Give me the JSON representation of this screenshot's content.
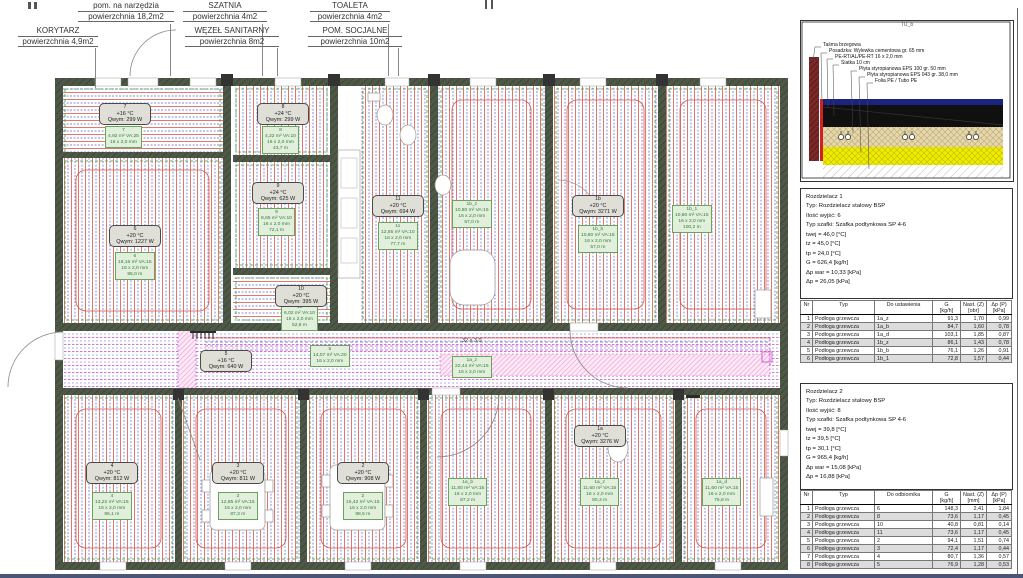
{
  "top_labels": [
    {
      "title": "KORYTARZ",
      "area": "powierzchnia 4,9m2"
    },
    {
      "title": "pom. na narzędzia",
      "area": "powierzchnia 18,2m2"
    },
    {
      "title": "SZATNIA",
      "area": "powierzchnia 4m2"
    },
    {
      "title": "WĘZEŁ SANITARNY",
      "area": "powierzchnia 8m2"
    },
    {
      "title": "TOALETA",
      "area": "powierzchnia 4m2"
    },
    {
      "title": "POM. SOCJALNE",
      "area": "powierzchnia 10m2"
    }
  ],
  "plan": {
    "boxes": {
      "b7": {
        "num": "7",
        "temp": "+16 °C",
        "q": "Qwym: 299 W"
      },
      "b8": {
        "num": "8",
        "temp": "+24 °C",
        "q": "Qwym: 299 W"
      },
      "b6": {
        "num": "6",
        "temp": "+20 °C",
        "q": "Qwym: 1227 W"
      },
      "b9": {
        "num": "9",
        "temp": "+24 °C",
        "q": "Qwym: 625 W"
      },
      "b11": {
        "num": "11",
        "temp": "+20 °C",
        "q": "Qwym: 694 W"
      },
      "b10": {
        "num": "10",
        "temp": "+20 °C",
        "q": "Qwym: 395 W"
      },
      "b5": {
        "num": "5",
        "temp": "+16 °C",
        "q": "Qwym: 640 W"
      },
      "b4": {
        "num": "4",
        "temp": "+20 °C",
        "q": "Qwym: 812 W"
      },
      "b3": {
        "num": "3",
        "temp": "+20 °C",
        "q": "Qwym: 811 W"
      },
      "b2": {
        "num": "2",
        "temp": "+20 °C",
        "q": "Qwym: 908 W"
      },
      "b1b": {
        "num": "1b",
        "temp": "+20 °C",
        "q": "Qwym: 3271 W"
      },
      "b1a": {
        "num": "1a",
        "temp": "+20 °C",
        "q": "Qwym: 3276 W"
      }
    },
    "green": {
      "g7": "7\n4,92 m² VA:25\n16 x 2,0 mm",
      "g8": "8\n4,22 m² VA:10\n16 x 2,0 mm\n43,7 m",
      "g6": "6\n18,16 m² VA:15\n16 x 2,0 mm\n95,0 m",
      "g9": "9\n8,65 m² VA:10\n16 x 2,0 mm\n72,1 m",
      "g11": "11\n12,55 m² VA:10\n16 x 2,0 mm\n77,7 m",
      "g10": "10\n6,02 m² VA:10\n16 x 2,0 mm\n52,8 m",
      "g5": "5\n14,07 m² VA:20\n16 x 2,0 mm",
      "g4": "4\n13,22 m² VA:15\n16 x 2,0 mm\n86,1 m",
      "g3": "3\n12,85 m² VA:15\n16 x 2,0 mm\n87,3 m",
      "g2": "2\n15,42 m² VA:15\n16 x 2,0 mm\n88,5 m",
      "g1bz": "1b_z\n10,80 m² VA:15\n16 x 2,0 mm\n57,0 m",
      "g1bb": "1b_b\n10,80 m² VA:15\n16 x 2,0 mm\n57,0 m",
      "g1b1": "1b_1\n10,80 m² VA:15\n16 x 2,0 mm\n100,2 m",
      "g1ab": "1a_b\n11,80 m² VA:15\n16 x 2,0 mm\n87,2 m",
      "g1az": "1a_z\n11,60 m² VA:15\n16 x 2,0 mm\n80,3 m",
      "g1ad": "1a_d\n11,60 m² VA:15\n16 x 2,0 mm\n75,8 m",
      "g1acorr": "1a_z\n22,44 m² VA:15\n16 x 2,0 mm"
    },
    "pipe_dim": "32 x 3,0"
  },
  "detail": {
    "title": "TU_b",
    "layers": [
      "Taśma brzegowa",
      "Posadzka: Wylewka cementowa gr. 65 mm",
      "PE-RT/AL/PE-RT 16 x 2,0 mm",
      "Siatka 10 cm",
      "Płyta styropianowa EPS 100 gr. 50 mm",
      "Płyta styropianowa EPS 043 gr. 38,0 mm",
      "Folia PE / Tubo PE"
    ]
  },
  "r1": {
    "text": "Rozdzielacz 1\nTyp: Rozdzielacz stalowy BSP\nIlość wyjść: 6\nTyp szafki: Szafka podtynkowa SP 4-6\ntwej = 46,0 [°C]\ntz = 45,0 [°C]\ntp = 24,0 [°C]\nG = 626,4 [kg/h]\nΔp war = 10,33 [kPa]\nΔp = 26,05 [kPa]"
  },
  "r2": {
    "text": "Rozdzielacz 2\nTyp: Rozdzielacz stalowy BSP\nIlość wyjść: 8\nTyp szafki: Szafka podtynkowa SP 4-6\ntwej = 39,8 [°C]\ntz = 39,5 [°C]\ntp = 30,1 [°C]\nG = 965,4 [kg/h]\nΔp war = 15,08 [kPa]\nΔp = 16,88 [kPa]"
  },
  "table1": {
    "headers": [
      "Nr",
      "Typ",
      "Do ustawienia",
      "G\n[kg/h]",
      "Nast. (Z)\n[obr]",
      "Δp (P)\n[kPa]"
    ],
    "rows": [
      [
        "1",
        "Podłoga grzewcza",
        "1a_z",
        "91,3",
        "1,70",
        "0,99"
      ],
      [
        "2",
        "Podłoga grzewcza",
        "1a_b",
        "84,7",
        "1,60",
        "0,78"
      ],
      [
        "3",
        "Podłoga grzewcza",
        "1a_d",
        "103,1",
        "1,85",
        "0,87"
      ],
      [
        "4",
        "Podłoga grzewcza",
        "1b_z",
        "86,1",
        "1,43",
        "0,78"
      ],
      [
        "5",
        "Podłoga grzewcza",
        "1b_b",
        "76,1",
        "1,26",
        "0,91"
      ],
      [
        "6",
        "Podłoga grzewcza",
        "1b_1",
        "72,8",
        "1,57",
        "0,44"
      ]
    ]
  },
  "table2": {
    "headers": [
      "Nr",
      "Typ",
      "Do odbiornika",
      "G\n[kg/h]",
      "Nast. (Z)\n[mm]",
      "Δp (P)\n[kPa]"
    ],
    "rows": [
      [
        "1",
        "Podłoga grzewcza",
        "6",
        "148,3",
        "2,41",
        "1,84"
      ],
      [
        "2",
        "Podłoga grzewcza",
        "8",
        "73,6",
        "1,17",
        "0,45"
      ],
      [
        "3",
        "Podłoga grzewcza",
        "10",
        "40,8",
        "0,81",
        "0,14"
      ],
      [
        "4",
        "Podłoga grzewcza",
        "11",
        "73,6",
        "1,17",
        "0,45"
      ],
      [
        "5",
        "Podłoga grzewcza",
        "2",
        "94,1",
        "1,51",
        "0,74"
      ],
      [
        "6",
        "Podłoga grzewcza",
        "3",
        "72,4",
        "1,17",
        "0,44"
      ],
      [
        "7",
        "Podłoga grzewcza",
        "4",
        "80,7",
        "1,36",
        "0,57"
      ],
      [
        "8",
        "Podłoga grzewcza",
        "5",
        "76,9",
        "1,28",
        "0,53"
      ]
    ]
  },
  "colors": {
    "loop_red": "#d85545",
    "loop_blue": "#5a64c8",
    "perimeter_green": "#3a9a40",
    "supply_magenta": "#c743c7",
    "hatch_pink": "#f0a2d8",
    "wall": "#4e5847",
    "detail_screed": "#101010",
    "detail_top": "#1a237e",
    "detail_ins1": "#e8d8a8",
    "detail_ins2": "#f0ec00",
    "detail_wall": "#7a2828"
  }
}
